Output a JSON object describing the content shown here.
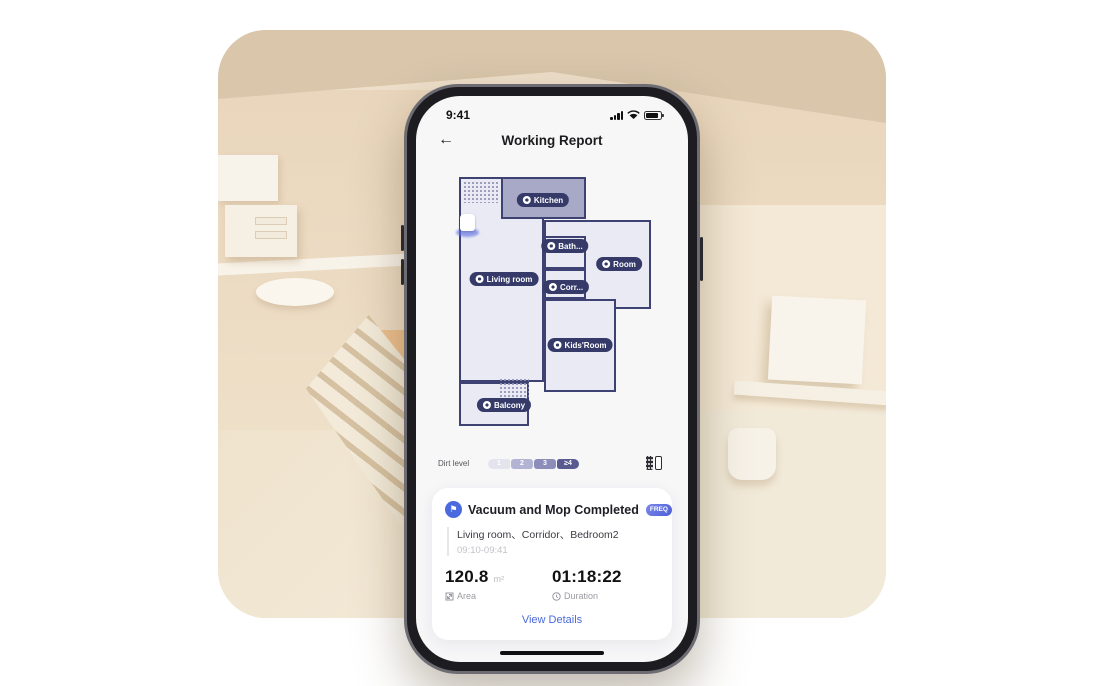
{
  "colors": {
    "accent_blue": "#4a6add",
    "map_wall": "#3d4273",
    "kitchen_fill": "#a7a9c6",
    "room_fill": "#e9eaf3",
    "scene_beige": "#eedfca"
  },
  "phone": {
    "status": {
      "time": "9:41"
    },
    "nav": {
      "title": "Working Report",
      "back_icon": "arrow-left"
    },
    "map": {
      "robot": "robot-vacuum",
      "labels": [
        {
          "text": "Kitchen"
        },
        {
          "text": "Bath..."
        },
        {
          "text": "Room"
        },
        {
          "text": "Living room"
        },
        {
          "text": "Corr..."
        },
        {
          "text": "Kids'Room"
        },
        {
          "text": "Balcony"
        }
      ]
    },
    "dirt": {
      "label": "Dirt level",
      "segments": [
        "1",
        "2",
        "3",
        "≥4"
      ]
    },
    "card": {
      "title": "Vacuum and Mop Completed",
      "badge": "FREQ",
      "rooms": "Living room、Corridor、Bedroom2",
      "time_range": "09:10-09:41",
      "area_value": "120.8",
      "area_unit": "m²",
      "area_label": "Area",
      "duration_value": "01:18:22",
      "duration_label": "Duration",
      "details_link": "View Details"
    }
  }
}
